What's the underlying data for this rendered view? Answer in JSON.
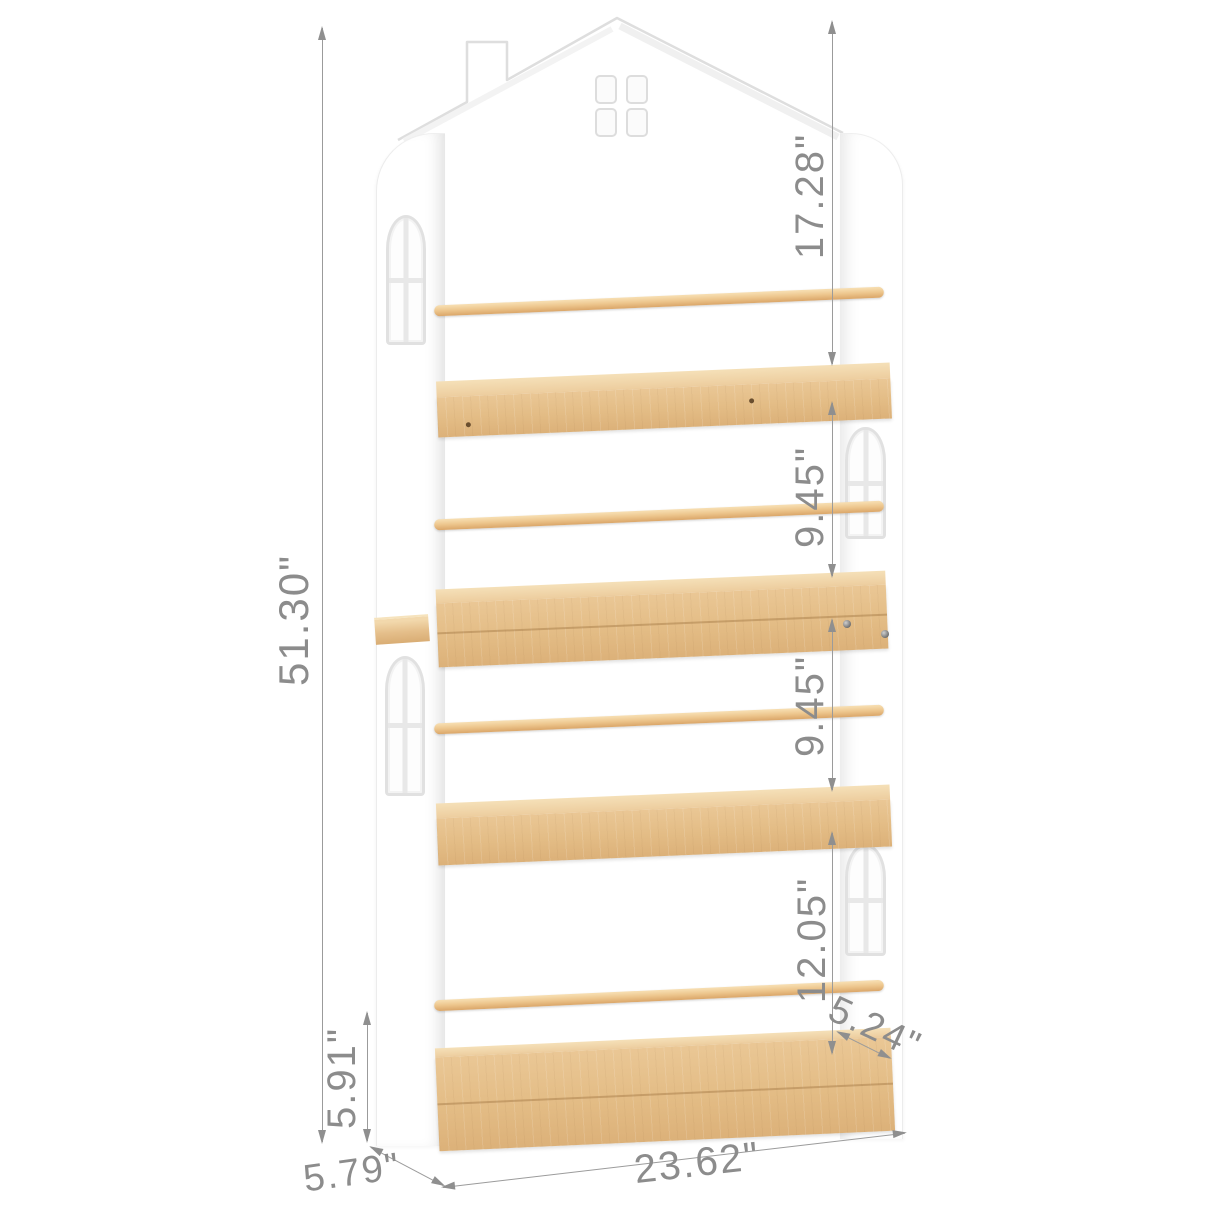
{
  "product_diagram": {
    "dimensions": {
      "total_height": "51.30\"",
      "top_section_height": "17.28\"",
      "second_shelf_spacing": "9.45\"",
      "third_shelf_spacing": "9.45\"",
      "fourth_section_height": "12.05\"",
      "base_section_height": "5.91\"",
      "side_depth": "5.79\"",
      "overall_width": "23.62\"",
      "shelf_depth": "5.24\""
    },
    "colors": {
      "wood": "#e8c592",
      "wood_light": "#f5e0b8",
      "wood_dark": "#dca96c",
      "panel_edge": "#e2e2e2",
      "dimension_text": "#8c8c8c",
      "dimension_line": "#9b9b9b"
    }
  }
}
